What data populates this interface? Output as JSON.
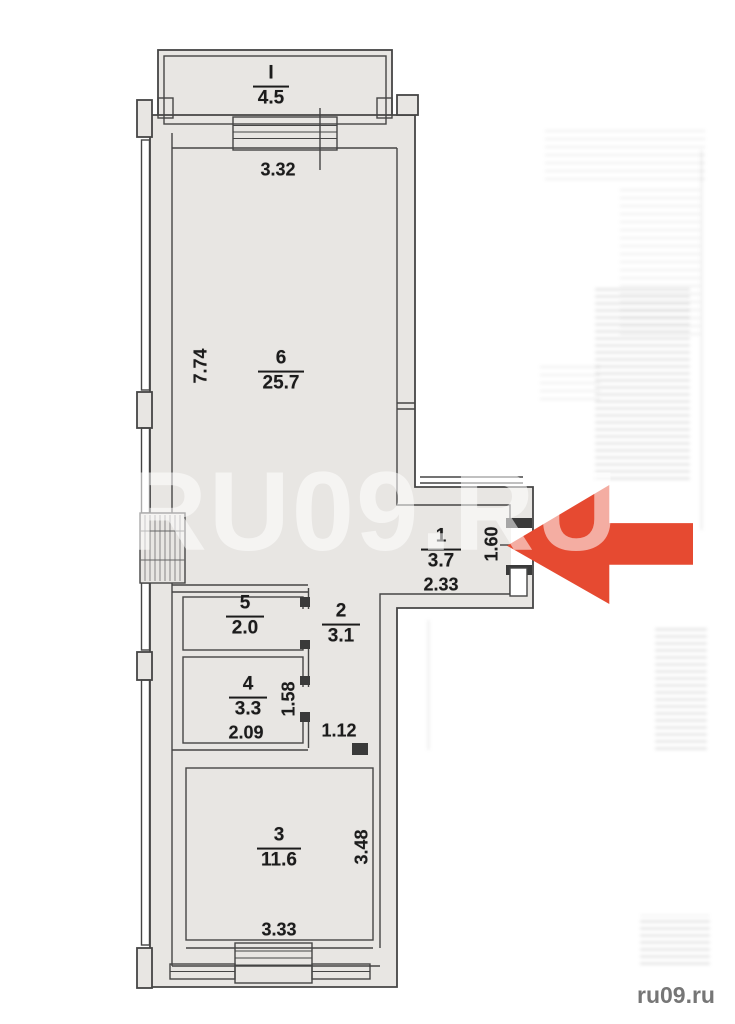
{
  "watermark": "RU09.RU",
  "credit": "ru09.ru",
  "rooms": {
    "balcony": {
      "number": "I",
      "area": "4.5"
    },
    "r6": {
      "number": "6",
      "area": "25.7"
    },
    "r1": {
      "number": "1",
      "area": "3.7"
    },
    "r2": {
      "number": "2",
      "area": "3.1"
    },
    "r5": {
      "number": "5",
      "area": "2.0"
    },
    "r4": {
      "number": "4",
      "area": "3.3"
    },
    "r3": {
      "number": "3",
      "area": "11.6"
    }
  },
  "dimensions": {
    "room6_top": "3.32",
    "room6_left": "7.74",
    "room1_bottom": "2.33",
    "room1_right": "1.60",
    "room4_bottom": "2.09",
    "room4_right": "1.58",
    "hall_door": "1.12",
    "room3_bottom": "3.33",
    "room3_right": "3.48"
  },
  "colors": {
    "arrow": "#e64a31",
    "floor": "#e8e6e3",
    "wall_line": "#454545"
  }
}
